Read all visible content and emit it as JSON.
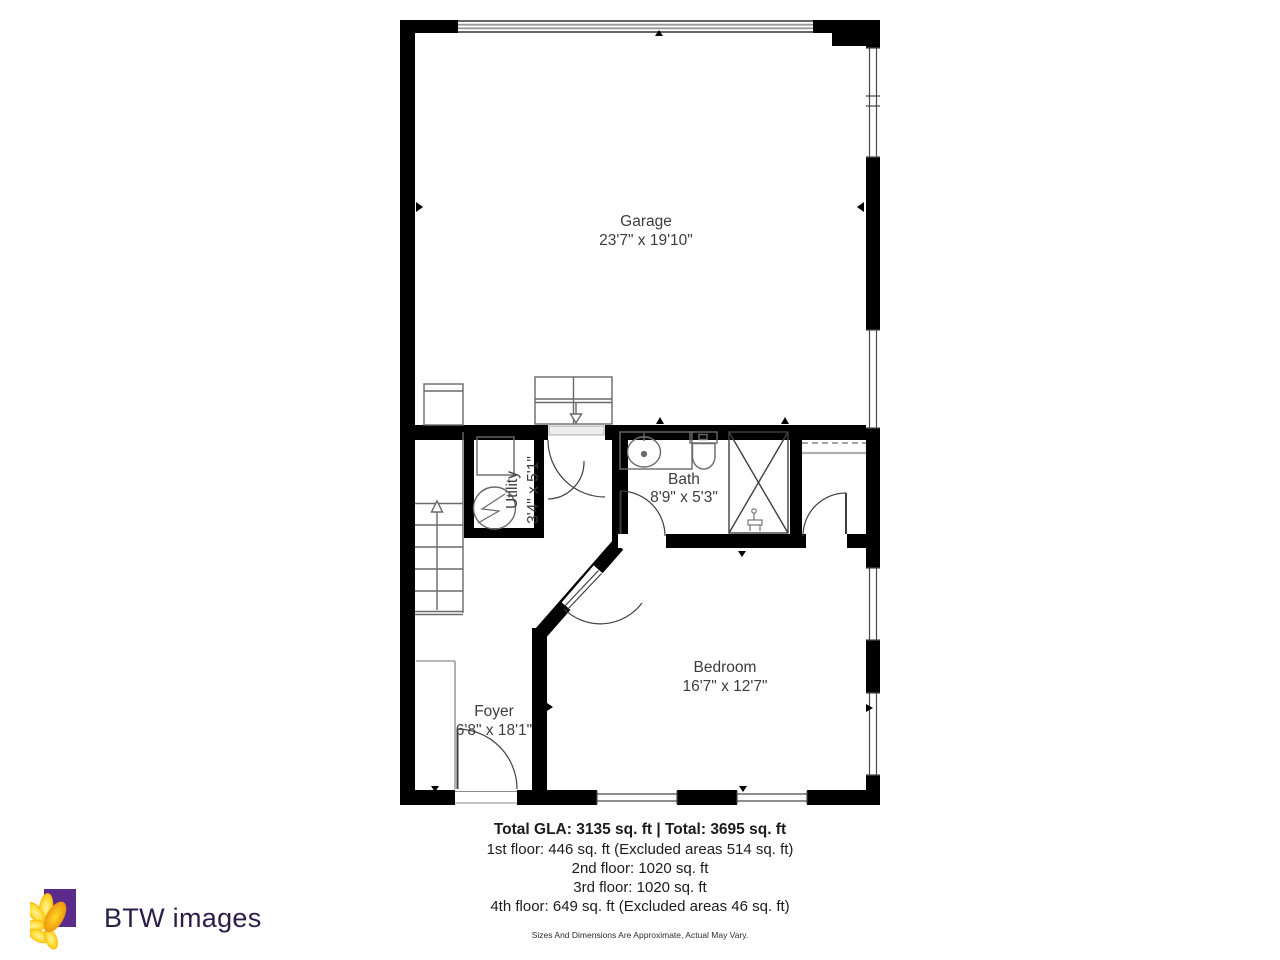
{
  "plan": {
    "rooms": [
      {
        "name": "Garage",
        "dims": "23'7\" x 19'10\""
      },
      {
        "name": "Utility",
        "dims": "3'4\" x 5'1\""
      },
      {
        "name": "Bath",
        "dims": "8'9\" x 5'3\""
      },
      {
        "name": "Bedroom",
        "dims": "16'7\" x 12'7\""
      },
      {
        "name": "Foyer",
        "dims": "6'8\" x 18'1\""
      }
    ]
  },
  "summary": {
    "total_line": "Total GLA: 3135 sq. ft | Total: 3695 sq. ft",
    "floors": [
      "1st floor: 446 sq. ft (Excluded areas 514 sq. ft)",
      "2nd floor: 1020 sq. ft",
      "3rd floor: 1020 sq. ft",
      "4th floor: 649 sq. ft (Excluded areas 46 sq. ft)"
    ],
    "disclaimer": "Sizes And Dimensions Are Approximate, Actual May Vary."
  },
  "branding": {
    "logo_text": "BTW images",
    "colors": {
      "square": "#5b2b8c",
      "petal_light": "#ffd928",
      "petal_deep": "#f59300",
      "text": "#2b1c4a"
    }
  },
  "colors": {
    "walls": "#000000",
    "background": "#ffffff",
    "fixtures": "#6a6a6a"
  }
}
